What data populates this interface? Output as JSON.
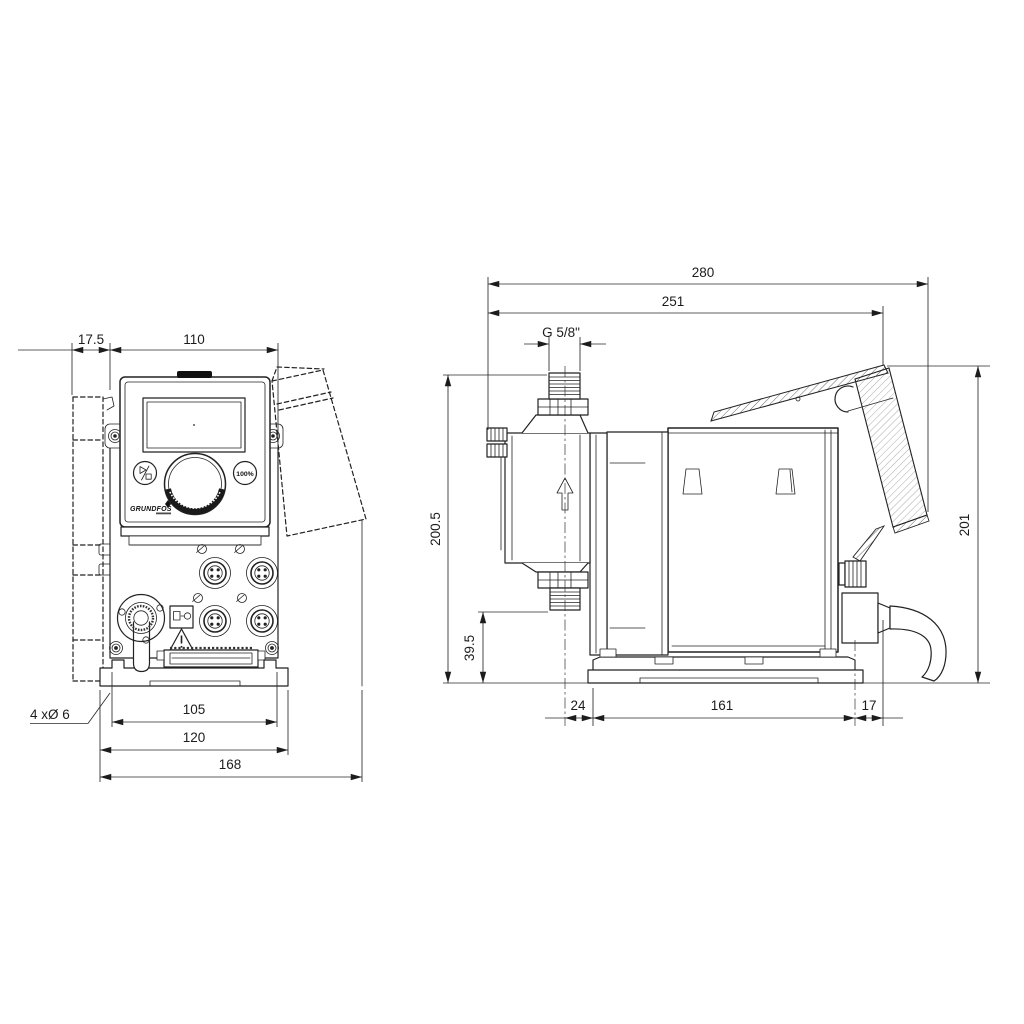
{
  "front_view": {
    "dimensions": {
      "bracket_offset": "17.5",
      "body_width": "110",
      "slot_spacing": "105",
      "plate_width": "120",
      "overall_width": "168",
      "mounting_holes": "4 xØ 6"
    },
    "panel": {
      "logo": "GRUNDFOS",
      "capacity_button": "100%"
    }
  },
  "side_view": {
    "dimensions": {
      "overall_depth": "280",
      "depth_to_bracket": "251",
      "connection_thread": "G 5/8\"",
      "overall_height": "200.5",
      "valve_clearance": "39.5",
      "head_overhang": "24",
      "base_length": "161",
      "rear_overhang": "17",
      "bracket_height": "201"
    }
  }
}
